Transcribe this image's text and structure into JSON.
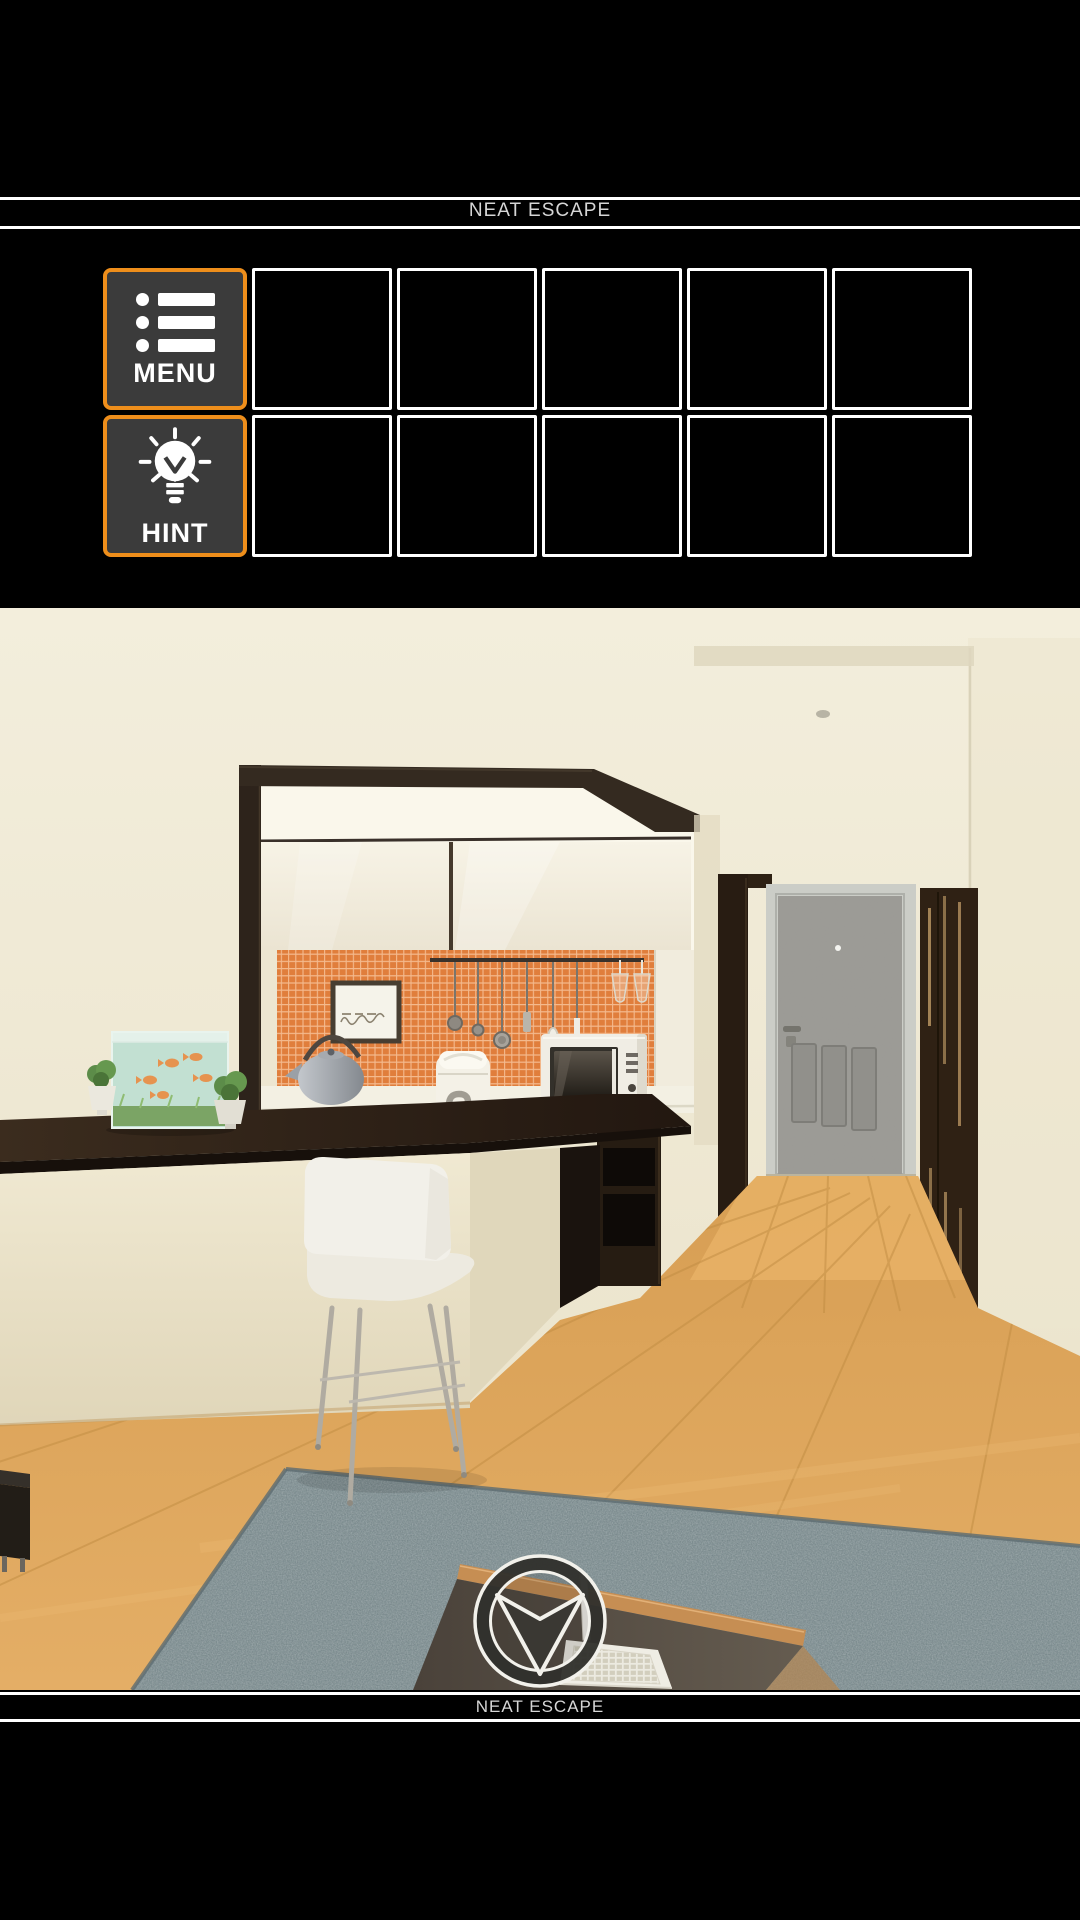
{
  "header": {
    "brand": "NEAT ESCAPE"
  },
  "footer": {
    "brand": "NEAT ESCAPE"
  },
  "menu_button": {
    "label": "MENU"
  },
  "hint_button": {
    "label": "HINT"
  },
  "inventory": {
    "rows": 2,
    "empty_slots_per_row": 5
  },
  "icons": {
    "menu": "list-icon",
    "hint": "bulb-icon",
    "navigation": "down-arrow-icon"
  },
  "colors": {
    "page_bg": "#000000",
    "accent_orange": "#EE8E1B",
    "button_bg": "#3B3B3B",
    "slot_border": "#FFFFFF",
    "banner_text": "#D6D6D6",
    "wall_cream": "#EFE9D3",
    "tile_orange": "#E07E3C",
    "dark_wood": "#2A1F16",
    "floor_wood": "#DCA45B",
    "rug_gray": "#76868A"
  },
  "scene": {
    "view": "kitchen-and-hallway",
    "navigation": {
      "down_arrow": "down"
    }
  }
}
